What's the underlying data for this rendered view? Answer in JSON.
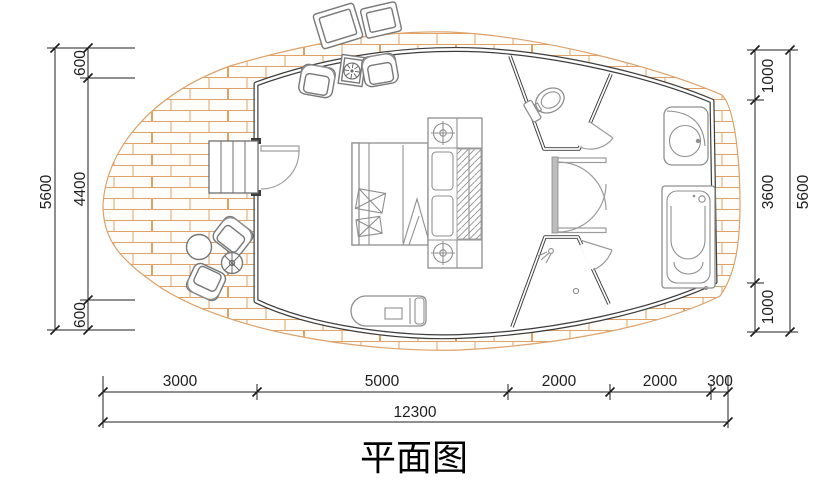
{
  "title": "平面图",
  "dimensions": {
    "left": {
      "total": "5600",
      "segments": [
        "600",
        "4400",
        "600"
      ]
    },
    "right": {
      "total": "5600",
      "segments": [
        "1000",
        "3600",
        "1000"
      ]
    },
    "bottom": {
      "total": "12300",
      "segments": [
        "3000",
        "5000",
        "2000",
        "2000",
        "300"
      ]
    }
  },
  "colors": {
    "wall": "#3c3c3c",
    "furniture": "#8f8f8f",
    "chair": "#787878",
    "brick": "#dfa26b",
    "dim": "#1f1f1f",
    "corridor": "#bdbdbd"
  },
  "symbols": [
    "brick-paved-deck",
    "curved-cabin-wall",
    "entry-stairs",
    "entrance-door",
    "double-bed",
    "wardrobe-closet",
    "ceiling-light",
    "armchair",
    "tea-table",
    "toilet",
    "wash-basin",
    "bathtub",
    "shower-head",
    "floor-drain",
    "lounge-daybed",
    "outdoor-round-table",
    "outdoor-flower-table",
    "outdoor-chair",
    "dimension-line",
    "dimension-tick"
  ]
}
